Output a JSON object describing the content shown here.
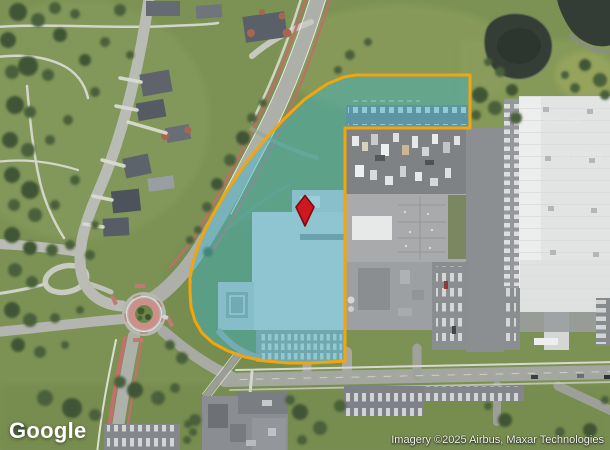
{
  "branding": {
    "logo_text": "Google"
  },
  "attribution": {
    "text": "Imagery ©2025 Airbus, Maxar Technologies"
  },
  "watermark": {
    "text": "© 2025 Google"
  },
  "map": {
    "type": "satellite",
    "parcel": {
      "fill_color": "#3AB4CC",
      "fill_opacity": "0.44",
      "outline_color": "#F3A50C",
      "outline_width": "3",
      "outline_points": [
        [
          356,
          75
        ],
        [
          470,
          75
        ],
        [
          470,
          128
        ],
        [
          345,
          128
        ],
        [
          345,
          361
        ],
        [
          330,
          362
        ],
        [
          310,
          363
        ],
        [
          288,
          363
        ],
        [
          265,
          361
        ],
        [
          245,
          357
        ],
        [
          228,
          351
        ],
        [
          213,
          343
        ],
        [
          202,
          333
        ],
        [
          195,
          321
        ],
        [
          191,
          307
        ],
        [
          190,
          292
        ],
        [
          190,
          278
        ],
        [
          193,
          262
        ],
        [
          200,
          241
        ],
        [
          211,
          218
        ],
        [
          226,
          192
        ],
        [
          243,
          167
        ],
        [
          262,
          143
        ],
        [
          283,
          120
        ],
        [
          305,
          99
        ],
        [
          327,
          84
        ],
        [
          344,
          77
        ]
      ]
    },
    "marker": {
      "x": 305,
      "y": 211,
      "fill_color": "#CE171E",
      "border_color": "#7E0A0F"
    }
  }
}
